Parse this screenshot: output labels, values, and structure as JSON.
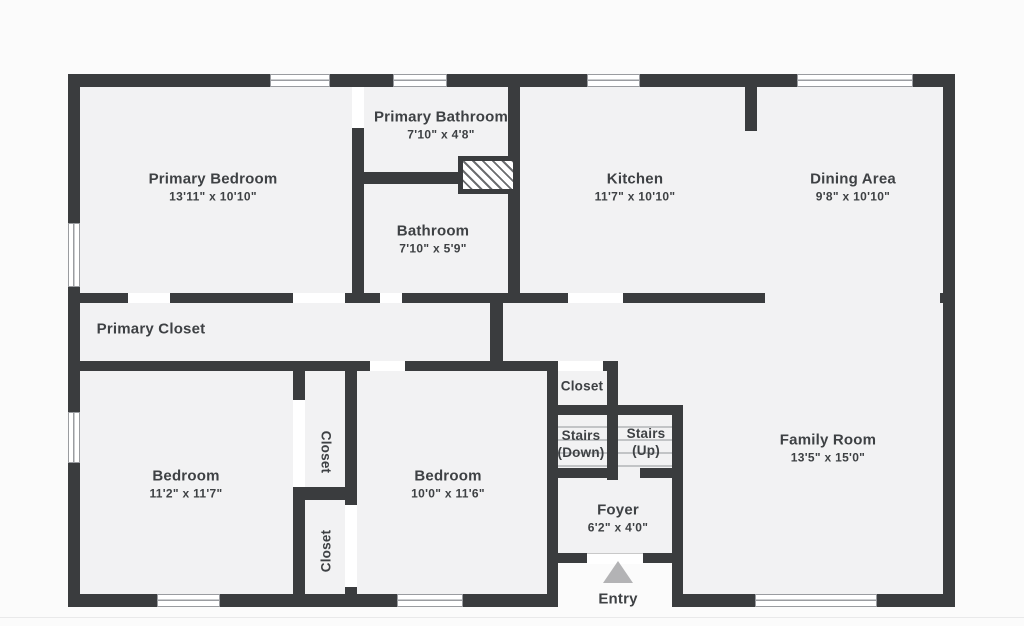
{
  "colors": {
    "bg": "#fbfbfb",
    "floor": "#f2f2f3",
    "wall": "#3a3c3e",
    "ink": "#3e4144",
    "window_line": "#9a9ca0",
    "step_line": "#c2c4c6",
    "entry_arrow": "#b3b3b5"
  },
  "rooms": {
    "primary_bedroom": {
      "name": "Primary Bedroom",
      "dims": "13'11\" x 10'10\""
    },
    "primary_bathroom": {
      "name": "Primary Bathroom",
      "dims": "7'10\" x 4'8\""
    },
    "bathroom": {
      "name": "Bathroom",
      "dims": "7'10\" x 5'9\""
    },
    "kitchen": {
      "name": "Kitchen",
      "dims": "11'7\" x 10'10\""
    },
    "dining_area": {
      "name": "Dining Area",
      "dims": "9'8\" x 10'10\""
    },
    "primary_closet": {
      "name": "Primary Closet"
    },
    "bedroom_left": {
      "name": "Bedroom",
      "dims": "11'2\" x 11'7\""
    },
    "bedroom_middle": {
      "name": "Bedroom",
      "dims": "10'0\" x 11'6\""
    },
    "closet_bedroom_left": {
      "name": "Closet"
    },
    "closet_bedroom_middle": {
      "name": "Closet"
    },
    "closet_hall": {
      "name": "Closet"
    },
    "stairs_down": {
      "line1": "Stairs",
      "line2": "(Down)"
    },
    "stairs_up": {
      "line1": "Stairs",
      "line2": "(Up)"
    },
    "family_room": {
      "name": "Family Room",
      "dims": "13'5\" x 15'0\""
    },
    "foyer": {
      "name": "Foyer",
      "dims": "6'2\" x 4'0\""
    },
    "entry": {
      "name": "Entry"
    }
  }
}
